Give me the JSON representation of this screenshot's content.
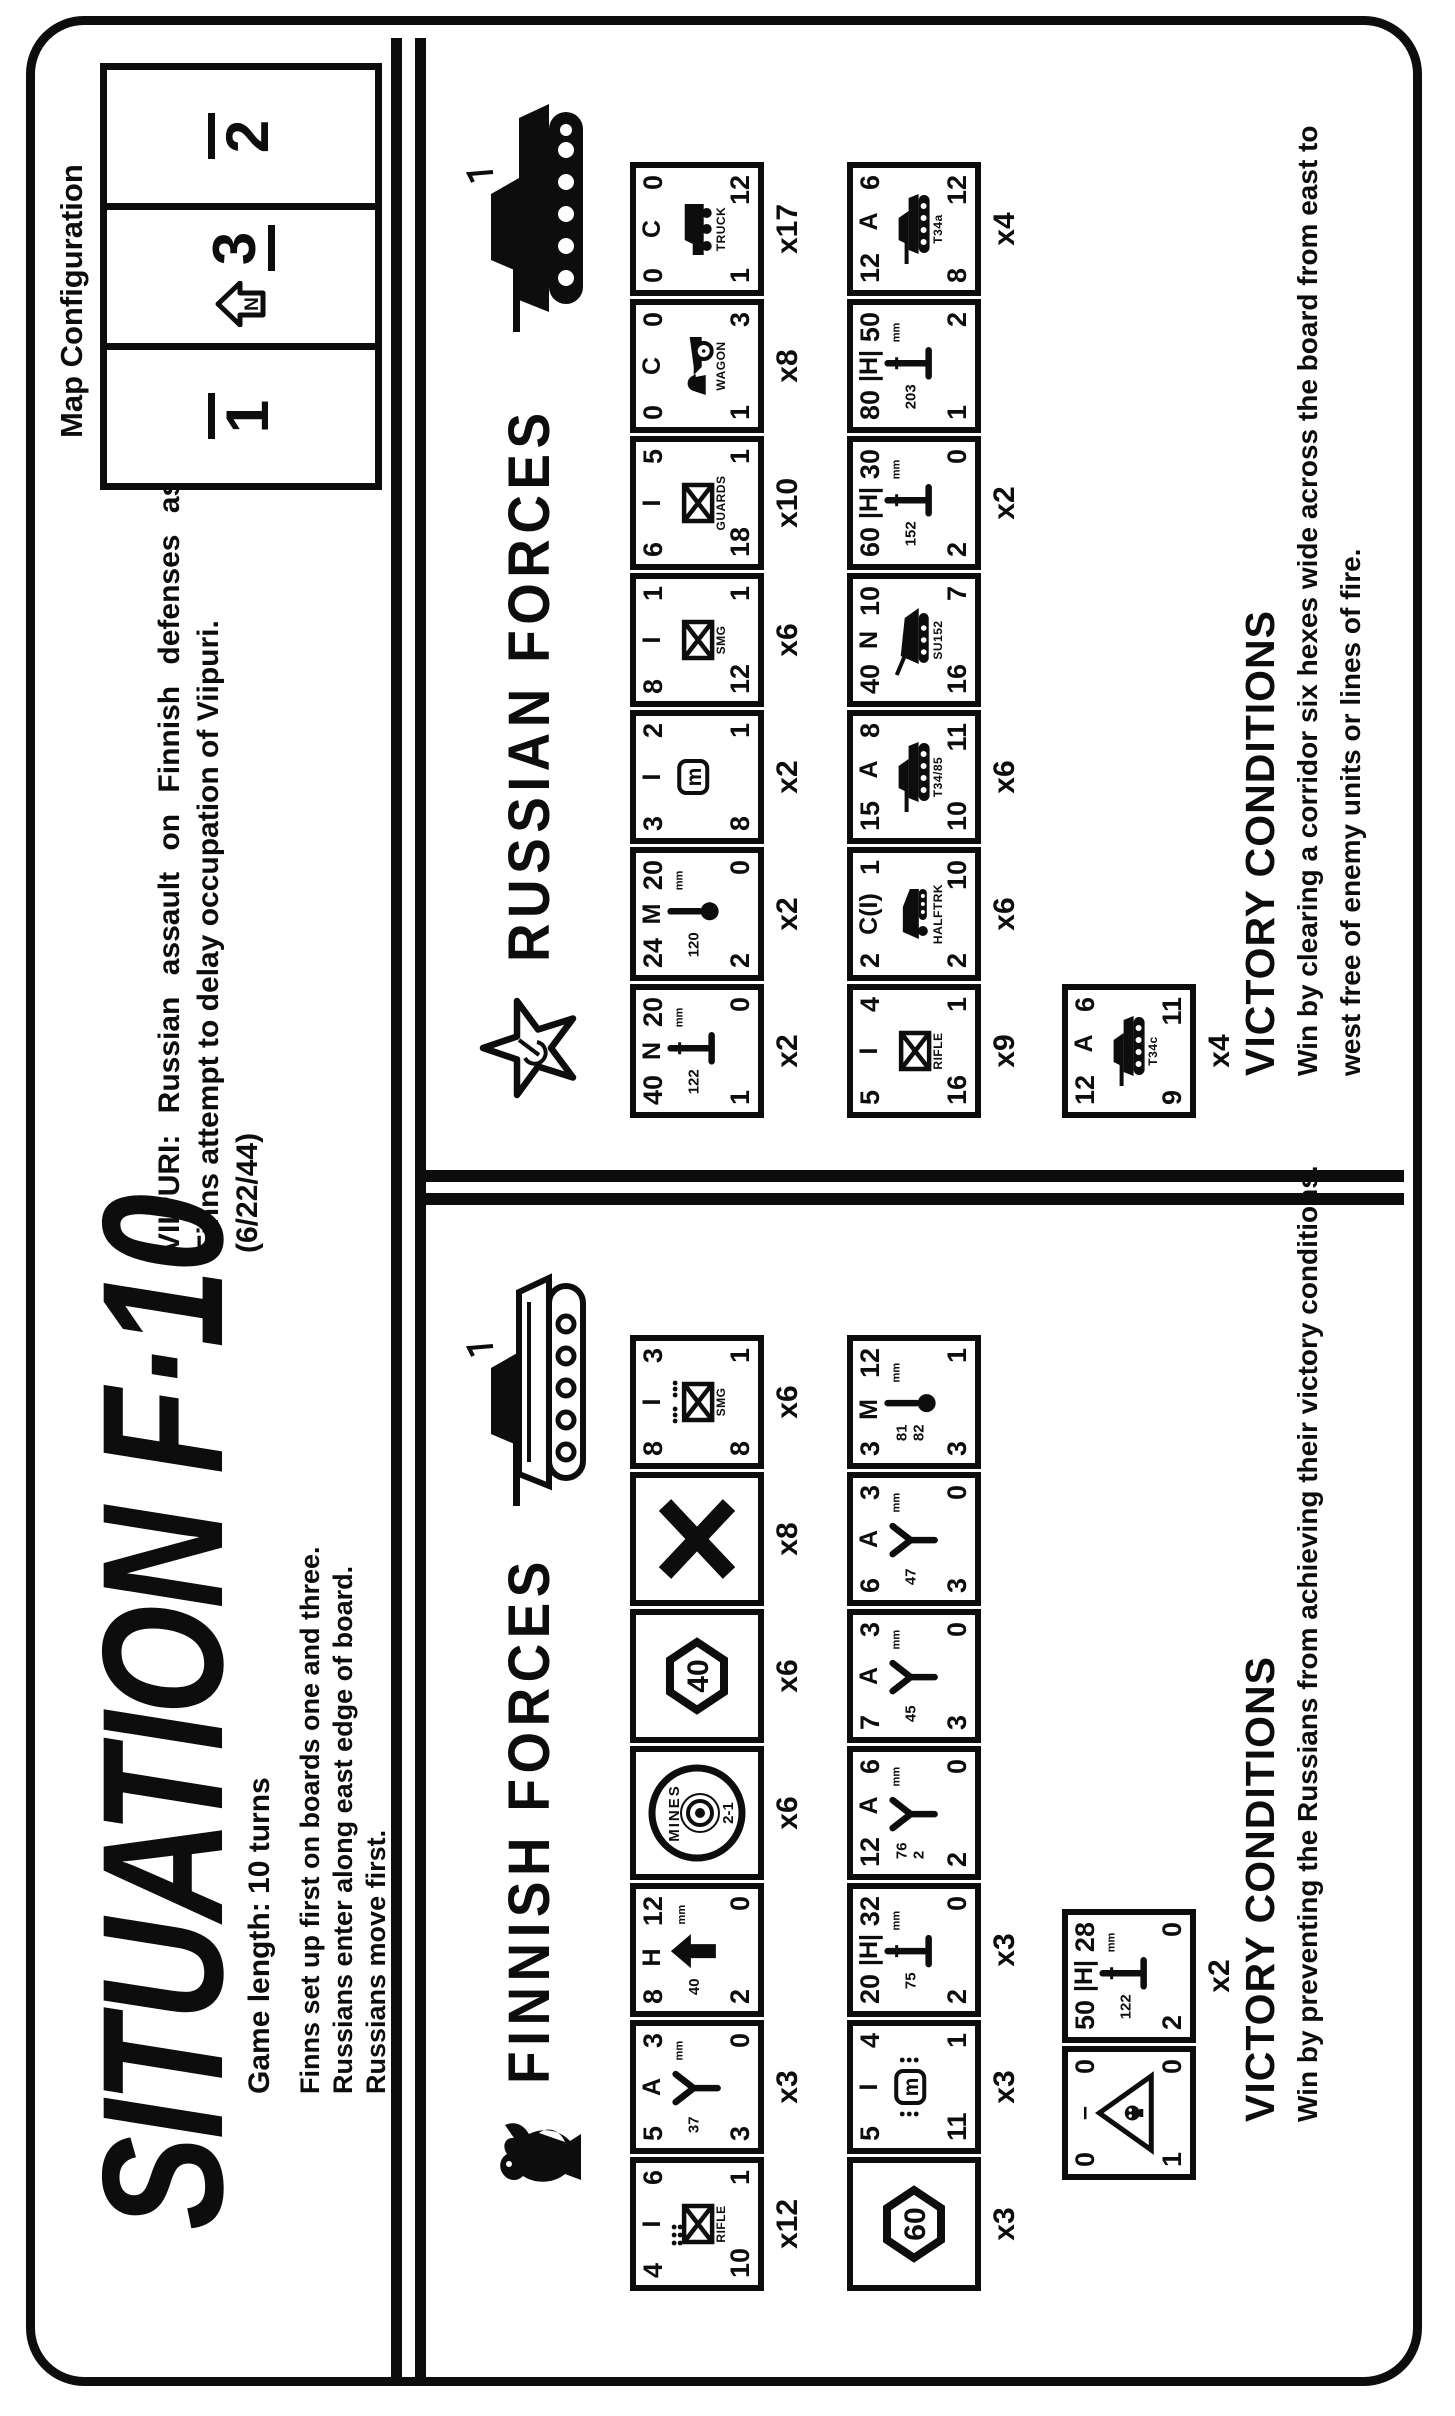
{
  "title": "SITUATION F·10",
  "map_config": {
    "heading": "Map Configuration",
    "boards": [
      {
        "num": "1",
        "bar": "over",
        "north": false
      },
      {
        "num": "3",
        "bar": "under",
        "north": true
      },
      {
        "num": "2",
        "bar": "over",
        "north": false
      }
    ]
  },
  "scenario": {
    "line1": "VIIPURI:  Russian  assault  on  Finnish  defenses  as",
    "line2": "Finns attempt to delay occupation of Viipuri.",
    "line3": "(6/22/44)"
  },
  "game_info": {
    "length": "Game length:  10 turns",
    "rules": [
      "Finns set up first on boards one and three.",
      "Russians enter along east edge of board.",
      "Russians move first."
    ]
  },
  "finnish": {
    "header": "FINNISH FORCES",
    "emblem": "finnish-lion",
    "row1": [
      {
        "top": [
          "4",
          "I",
          "6"
        ],
        "icon": "xbox",
        "dots": "block",
        "label": "RIFLE",
        "bl": "10",
        "br": "1",
        "mult": "x12"
      },
      {
        "top": [
          "5",
          "A",
          "3"
        ],
        "icon": "ygun",
        "cal": "37",
        "bl": "3",
        "br": "0",
        "mult": "x3"
      },
      {
        "top": [
          "8",
          "H",
          "12"
        ],
        "icon": "aa",
        "cal": "40",
        "bl": "2",
        "br": "0",
        "mult": ""
      },
      {
        "icon": "mines",
        "label": "MINES",
        "sub": "2-1",
        "mult": "x6"
      },
      {
        "icon": "hex",
        "val": "40",
        "mult": "x6"
      },
      {
        "icon": "bigx",
        "mult": "x8"
      },
      {
        "top": [
          "8",
          "I",
          "3"
        ],
        "icon": "xbox",
        "dots": "pair",
        "label": "SMG",
        "bl": "8",
        "br": "1",
        "mult": "x6"
      }
    ],
    "row2": [
      {
        "icon": "hex",
        "val": "60",
        "mult": "x3"
      },
      {
        "top": [
          "5",
          "I",
          "4"
        ],
        "icon": "mbox",
        "dots": "side",
        "bl": "11",
        "br": "1",
        "mult": "x3"
      },
      {
        "top": [
          "20",
          "|H|",
          "32"
        ],
        "icon": "gun",
        "cal": "75",
        "bl": "2",
        "br": "0",
        "mult": "x3"
      },
      {
        "top": [
          "12",
          "A",
          "6"
        ],
        "icon": "ygun",
        "cal": "76 2",
        "bl": "2",
        "br": "0",
        "mult": ""
      },
      {
        "top": [
          "7",
          "A",
          "3"
        ],
        "icon": "ygun",
        "cal": "45",
        "bl": "3",
        "br": "0",
        "mult": ""
      },
      {
        "top": [
          "6",
          "A",
          "3"
        ],
        "icon": "ygun",
        "cal": "47",
        "bl": "3",
        "br": "0",
        "mult": ""
      },
      {
        "top": [
          "3",
          "M",
          "12"
        ],
        "icon": "mortar",
        "cal": "81 82",
        "bl": "3",
        "br": "1",
        "mult": ""
      }
    ],
    "row3": [
      {
        "top": [
          "0",
          "–",
          "0"
        ],
        "icon": "tri",
        "bl": "1",
        "br": "0",
        "mult": ""
      },
      {
        "top": [
          "50",
          "|H|",
          "28"
        ],
        "icon": "gun",
        "cal": "122",
        "bl": "2",
        "br": "0",
        "mult": "x2"
      }
    ],
    "victory": {
      "heading": "VICTORY CONDITIONS",
      "lines": [
        "Win by preventing the Russians from achieving their victory conditions."
      ]
    }
  },
  "russian": {
    "header": "RUSSIAN FORCES",
    "emblem": "soviet-star",
    "row1": [
      {
        "top": [
          "40",
          "N",
          "20"
        ],
        "icon": "gun",
        "cal": "122",
        "bl": "1",
        "br": "0",
        "mult": "x2"
      },
      {
        "top": [
          "24",
          "M",
          "20"
        ],
        "icon": "mortar",
        "cal": "120",
        "bl": "2",
        "br": "0",
        "mult": "x2"
      },
      {
        "top": [
          "3",
          "I",
          "2"
        ],
        "icon": "mbox",
        "bl": "8",
        "br": "1",
        "mult": "x2"
      },
      {
        "top": [
          "8",
          "I",
          "1"
        ],
        "icon": "xbox",
        "label": "SMG",
        "bl": "12",
        "br": "1",
        "mult": "x6"
      },
      {
        "top": [
          "6",
          "I",
          "5"
        ],
        "icon": "xbox",
        "label": "GUARDS",
        "bl": "18",
        "br": "1",
        "mult": "x10"
      },
      {
        "top": [
          "0",
          "C",
          "0"
        ],
        "icon": "wagon",
        "label": "WAGON",
        "bl": "1",
        "br": "3",
        "mult": "x8"
      },
      {
        "top": [
          "0",
          "C",
          "0"
        ],
        "icon": "truck",
        "label": "TRUCK",
        "bl": "1",
        "br": "12",
        "mult": "x17"
      }
    ],
    "row2": [
      {
        "top": [
          "5",
          "I",
          "4"
        ],
        "icon": "xbox",
        "label": "RIFLE",
        "bl": "16",
        "br": "1",
        "mult": "x9"
      },
      {
        "top": [
          "2",
          "C(I)",
          "1"
        ],
        "icon": "halftrack",
        "label": "HALFTRK",
        "bl": "2",
        "br": "10",
        "mult": "x6"
      },
      {
        "top": [
          "15",
          "A",
          "8"
        ],
        "icon": "tank",
        "label": "T34/85",
        "bl": "10",
        "br": "11",
        "mult": "x6"
      },
      {
        "top": [
          "40",
          "N",
          "10"
        ],
        "icon": "su",
        "label": "SU152",
        "bl": "16",
        "br": "7",
        "mult": ""
      },
      {
        "top": [
          "60",
          "|H|",
          "30"
        ],
        "icon": "gun",
        "cal": "152",
        "bl": "2",
        "br": "0",
        "mult": "x2"
      },
      {
        "top": [
          "80",
          "|H|",
          "50"
        ],
        "icon": "gun",
        "cal": "203",
        "bl": "1",
        "br": "2",
        "mult": ""
      },
      {
        "top": [
          "12",
          "A",
          "6"
        ],
        "icon": "tank",
        "label": "T34a",
        "bl": "8",
        "br": "12",
        "mult": "x4"
      }
    ],
    "row3": [
      {
        "top": [
          "12",
          "A",
          "6"
        ],
        "icon": "tank",
        "label": "T34c",
        "bl": "9",
        "br": "11",
        "mult": "x4"
      }
    ],
    "victory": {
      "heading": "VICTORY CONDITIONS",
      "lines": [
        "Win by clearing a corridor six hexes wide across the board from east to",
        "west free of enemy units or lines of fire."
      ]
    }
  }
}
